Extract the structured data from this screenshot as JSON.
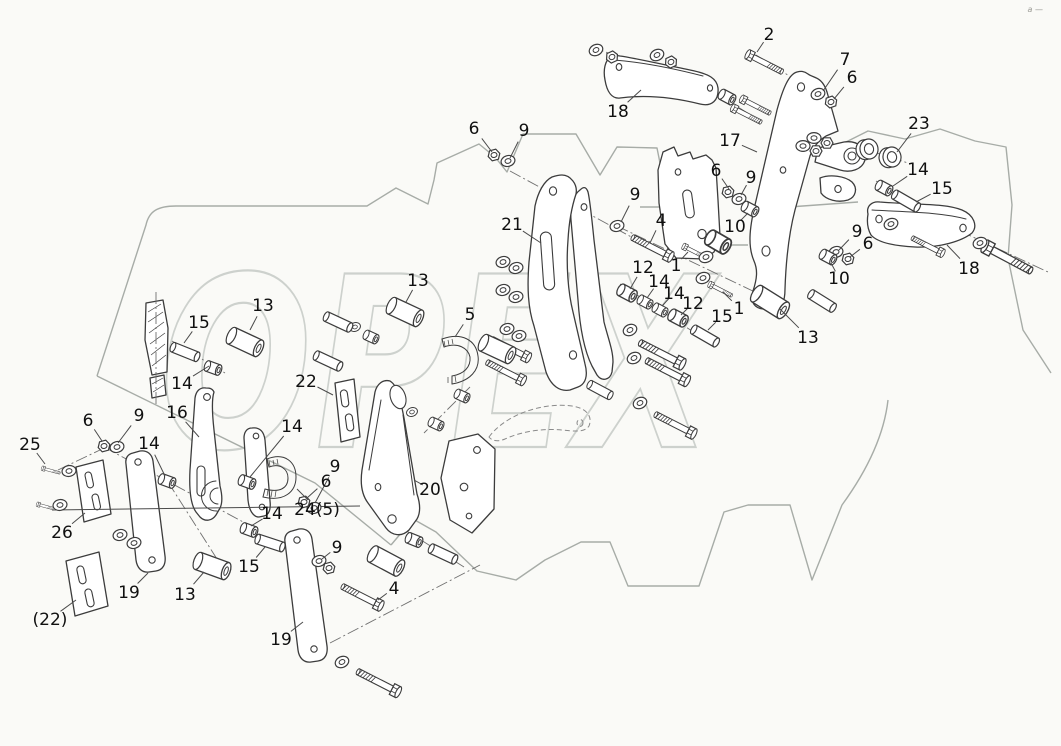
{
  "meta": {
    "title": "Exploded parts diagram",
    "watermark_text": "OPEX",
    "corner_mark": "a —",
    "colors": {
      "bg": "#fafaf7",
      "line": "#3c3c3c",
      "frame": "#a7aca7",
      "wm": "#cdd1cd",
      "label": "#101010",
      "leader": "#4a4a4a"
    }
  },
  "diagram": {
    "labels": [
      {
        "text": "2",
        "x": 769,
        "y": 34,
        "tx": 757,
        "ty": 52
      },
      {
        "text": "7",
        "x": 845,
        "y": 59,
        "tx": 823,
        "ty": 91
      },
      {
        "text": "6",
        "x": 852,
        "y": 77,
        "tx": 834,
        "ty": 99
      },
      {
        "text": "18",
        "x": 618,
        "y": 111,
        "tx": 641,
        "ty": 90
      },
      {
        "text": "17",
        "x": 730,
        "y": 140,
        "tx": 757,
        "ty": 152
      },
      {
        "text": "23",
        "x": 919,
        "y": 123,
        "tx": 897,
        "ty": 152
      },
      {
        "text": "6",
        "x": 474,
        "y": 128,
        "tx": 492,
        "ty": 152
      },
      {
        "text": "9",
        "x": 524,
        "y": 130,
        "tx": 510,
        "ty": 158
      },
      {
        "text": "14",
        "x": 918,
        "y": 169,
        "tx": 893,
        "ty": 186
      },
      {
        "text": "15",
        "x": 942,
        "y": 188,
        "tx": 916,
        "ty": 202
      },
      {
        "text": "21",
        "x": 512,
        "y": 224,
        "tx": 541,
        "ty": 243
      },
      {
        "text": "9",
        "x": 635,
        "y": 194,
        "tx": 621,
        "ty": 222
      },
      {
        "text": "4",
        "x": 661,
        "y": 220,
        "tx": 650,
        "ty": 243
      },
      {
        "text": "6",
        "x": 716,
        "y": 170,
        "tx": 729,
        "ty": 189
      },
      {
        "text": "9",
        "x": 751,
        "y": 177,
        "tx": 741,
        "ty": 195
      },
      {
        "text": "10",
        "x": 735,
        "y": 226,
        "tx": 748,
        "ty": 213
      },
      {
        "text": "9",
        "x": 857,
        "y": 231,
        "tx": 839,
        "ty": 250
      },
      {
        "text": "6",
        "x": 868,
        "y": 243,
        "tx": 850,
        "ty": 257
      },
      {
        "text": "10",
        "x": 839,
        "y": 278,
        "tx": 831,
        "ty": 263
      },
      {
        "text": "12",
        "x": 643,
        "y": 267,
        "tx": 630,
        "ty": 289
      },
      {
        "text": "14",
        "x": 659,
        "y": 281,
        "tx": 647,
        "ty": 298
      },
      {
        "text": "14",
        "x": 674,
        "y": 293,
        "tx": 662,
        "ty": 306
      },
      {
        "text": "12",
        "x": 693,
        "y": 303,
        "tx": 681,
        "ty": 315
      },
      {
        "text": "1",
        "x": 676,
        "y": 265,
        "tx": 688,
        "ty": 252
      },
      {
        "text": "15",
        "x": 722,
        "y": 316,
        "tx": 708,
        "ty": 330
      },
      {
        "text": "1",
        "x": 739,
        "y": 308,
        "tx": 723,
        "ty": 292
      },
      {
        "text": "13",
        "x": 808,
        "y": 337,
        "tx": 780,
        "ty": 309
      },
      {
        "text": "18",
        "x": 969,
        "y": 268,
        "tx": 947,
        "ty": 245
      },
      {
        "text": "13",
        "x": 418,
        "y": 280,
        "tx": 406,
        "ty": 302
      },
      {
        "text": "13",
        "x": 263,
        "y": 305,
        "tx": 250,
        "ty": 330
      },
      {
        "text": "15",
        "x": 199,
        "y": 322,
        "tx": 184,
        "ty": 343
      },
      {
        "text": "5",
        "x": 470,
        "y": 314,
        "tx": 455,
        "ty": 337
      },
      {
        "text": "22",
        "x": 306,
        "y": 381,
        "tx": 333,
        "ty": 395
      },
      {
        "text": "14",
        "x": 182,
        "y": 383,
        "tx": 209,
        "ty": 366
      },
      {
        "text": "16",
        "x": 177,
        "y": 412,
        "tx": 199,
        "ty": 437
      },
      {
        "text": "9",
        "x": 139,
        "y": 415,
        "tx": 118,
        "ty": 443
      },
      {
        "text": "6",
        "x": 88,
        "y": 420,
        "tx": 102,
        "ty": 441
      },
      {
        "text": "25",
        "x": 30,
        "y": 444,
        "tx": 45,
        "ty": 464
      },
      {
        "text": "14",
        "x": 149,
        "y": 443,
        "tx": 165,
        "ty": 476
      },
      {
        "text": "14",
        "x": 292,
        "y": 426,
        "tx": 250,
        "ty": 477
      },
      {
        "text": "9",
        "x": 335,
        "y": 466,
        "tx": 315,
        "ty": 503
      },
      {
        "text": "6",
        "x": 326,
        "y": 481,
        "tx": 307,
        "ty": 498
      },
      {
        "text": "26",
        "x": 62,
        "y": 532,
        "tx": 85,
        "ty": 513
      },
      {
        "text": "24(5)",
        "x": 317,
        "y": 509,
        "tx": 297,
        "ty": 489
      },
      {
        "text": "14",
        "x": 272,
        "y": 513,
        "tx": 251,
        "ty": 526
      },
      {
        "text": "20",
        "x": 430,
        "y": 489,
        "tx": 414,
        "ty": 480
      },
      {
        "text": "9",
        "x": 337,
        "y": 547,
        "tx": 322,
        "ty": 559
      },
      {
        "text": "15",
        "x": 249,
        "y": 566,
        "tx": 265,
        "ty": 547
      },
      {
        "text": "13",
        "x": 185,
        "y": 594,
        "tx": 204,
        "ty": 572
      },
      {
        "text": "19",
        "x": 129,
        "y": 592,
        "tx": 148,
        "ty": 573
      },
      {
        "text": "4",
        "x": 394,
        "y": 588,
        "tx": 378,
        "ty": 600
      },
      {
        "text": "19",
        "x": 281,
        "y": 639,
        "tx": 303,
        "ty": 622
      },
      {
        "text": "(22)",
        "x": 50,
        "y": 619,
        "tx": 76,
        "ty": 600
      }
    ]
  }
}
